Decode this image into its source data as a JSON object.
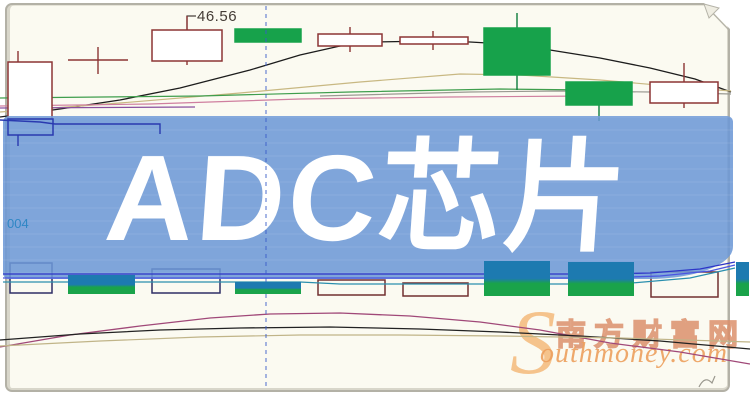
{
  "banner": {
    "title": "ADC芯片"
  },
  "price_flag": {
    "value": "46.56"
  },
  "left_label": {
    "value": "004"
  },
  "watermark": {
    "swoosh": "S",
    "cn": "南方财富网",
    "en": "outhmoney.com"
  },
  "colors": {
    "banner_fill": "rgba(108,152,214,0.87)",
    "banner_text": "#ffffff",
    "candle_up_stroke": "#8c3434",
    "candle_down_fill": "#17a24b",
    "down_wick": "#0e7d3c",
    "vol_teal": "#1d7ab0",
    "vol_green": "#1aa34a",
    "hollow_navy": "#2e2e66",
    "hollow_maroon": "#713030",
    "ma_black": "#1c1c1c",
    "ma_tan": "#c8b882",
    "ma_green": "#3f9e4d",
    "ma_pink": "#cf7f9f",
    "ma_purple": "#8a4f9e",
    "ma_gray": "#9a9a92",
    "ma_navy": "#2a3ab0",
    "ind_navy": "#2d35c8",
    "ind_blue": "#4a55e0",
    "ind_teal": "#2a8fae",
    "dash_blue": "#3a5cc8",
    "curve_magenta": "#a04878",
    "curve_black": "#222222",
    "curve_tan": "#c0b488",
    "flag": "#4a423c",
    "wm_orange": "#e8a060"
  },
  "chart_data": {
    "type": "candlestick",
    "title": "ADC芯片",
    "note": "stock K-line chart, no numeric axes visible; one flagged price 46.56; geometry in screenshot pixels",
    "candles": [
      {
        "type": "up",
        "x": 8,
        "y": 62,
        "w": 44,
        "h": 57,
        "wicks": [
          [
            18,
            51,
            62
          ]
        ]
      },
      {
        "type": "doji",
        "h": [
          68,
          128,
          60
        ],
        "v": [
          98,
          47,
          74
        ]
      },
      {
        "type": "up",
        "x": 152,
        "y": 30,
        "w": 70,
        "h": 31,
        "wicks": [
          [
            187,
            16,
            30
          ],
          [
            187,
            61,
            65
          ]
        ]
      },
      {
        "type": "down",
        "x": 235,
        "y": 29,
        "w": 66,
        "h": 13
      },
      {
        "type": "up",
        "x": 318,
        "y": 34,
        "w": 64,
        "h": 12,
        "wicks": [
          [
            350,
            27,
            34
          ],
          [
            350,
            46,
            52
          ]
        ]
      },
      {
        "type": "up",
        "x": 400,
        "y": 37,
        "w": 68,
        "h": 7,
        "wicks": [
          [
            433,
            31,
            37
          ],
          [
            433,
            44,
            50
          ]
        ]
      },
      {
        "type": "down",
        "x": 484,
        "y": 28,
        "w": 66,
        "h": 47,
        "wicks": [
          [
            517,
            13,
            28
          ],
          [
            517,
            75,
            90
          ]
        ]
      },
      {
        "type": "down",
        "x": 566,
        "y": 82,
        "w": 66,
        "h": 23,
        "wicks": [
          [
            599,
            105,
            121
          ]
        ]
      },
      {
        "type": "up",
        "x": 650,
        "y": 82,
        "w": 68,
        "h": 21,
        "wicks": [
          [
            684,
            63,
            82
          ],
          [
            684,
            103,
            108
          ]
        ]
      },
      {
        "type": "navy",
        "x": 8,
        "y": 119,
        "w": 45,
        "h": 16,
        "wicks": [
          [
            18,
            135,
            146
          ]
        ],
        "layer": "over"
      }
    ],
    "volume_bars": [
      {
        "kind": "hollow",
        "x": 10,
        "y": 263,
        "w": 42,
        "h": 30,
        "stroke": "hollow_navy"
      },
      {
        "kind": "filled",
        "x": 68,
        "y": 275,
        "w": 67,
        "h": 19
      },
      {
        "kind": "hollow",
        "x": 152,
        "y": 269,
        "w": 68,
        "h": 24,
        "stroke": "hollow_navy"
      },
      {
        "kind": "filled",
        "x": 235,
        "y": 282,
        "w": 66,
        "h": 12
      },
      {
        "kind": "hollow",
        "x": 318,
        "y": 280,
        "w": 67,
        "h": 15,
        "stroke": "hollow_maroon"
      },
      {
        "kind": "hollow",
        "x": 403,
        "y": 283,
        "w": 65,
        "h": 13,
        "stroke": "hollow_maroon"
      },
      {
        "kind": "filled",
        "x": 484,
        "y": 261,
        "w": 66,
        "h": 35
      },
      {
        "kind": "filled",
        "x": 568,
        "y": 262,
        "w": 66,
        "h": 34
      },
      {
        "kind": "hollow",
        "x": 651,
        "y": 272,
        "w": 67,
        "h": 25,
        "stroke": "hollow_maroon"
      },
      {
        "kind": "filled",
        "x": 736,
        "y": 262,
        "w": 13,
        "h": 34
      }
    ],
    "lines": [
      {
        "name": "ma-black-top",
        "color": "ma_black",
        "width": 1.3,
        "points": [
          [
            0,
            117
          ],
          [
            60,
            109
          ],
          [
            120,
            100
          ],
          [
            180,
            88
          ],
          [
            250,
            70
          ],
          [
            300,
            55
          ],
          [
            340,
            46
          ],
          [
            375,
            42
          ],
          [
            430,
            41
          ],
          [
            470,
            42
          ],
          [
            505,
            44
          ],
          [
            550,
            50
          ],
          [
            600,
            58
          ],
          [
            650,
            68
          ],
          [
            695,
            79
          ],
          [
            731,
            92
          ]
        ]
      },
      {
        "name": "ma-tan-top",
        "color": "ma_tan",
        "width": 1.2,
        "points": [
          [
            0,
            112
          ],
          [
            120,
            103
          ],
          [
            240,
            93
          ],
          [
            360,
            82
          ],
          [
            460,
            74
          ],
          [
            520,
            75
          ],
          [
            600,
            80
          ],
          [
            680,
            87
          ],
          [
            731,
            91
          ]
        ]
      },
      {
        "name": "ma-green-top",
        "color": "ma_green",
        "width": 1.2,
        "points": [
          [
            0,
            98
          ],
          [
            200,
            96
          ],
          [
            350,
            92
          ],
          [
            500,
            89
          ],
          [
            590,
            90
          ]
        ]
      },
      {
        "name": "ma-gray-top",
        "color": "ma_gray",
        "width": 1.2,
        "points": [
          [
            320,
            96
          ],
          [
            470,
            92
          ],
          [
            560,
            91
          ],
          [
            650,
            92
          ],
          [
            731,
            94
          ]
        ]
      },
      {
        "name": "ma-pink-top",
        "color": "ma_pink",
        "width": 1.2,
        "points": [
          [
            0,
            106
          ],
          [
            150,
            104
          ],
          [
            300,
            99
          ],
          [
            450,
            97
          ],
          [
            590,
            96
          ]
        ]
      },
      {
        "name": "ma-purple-top",
        "color": "ma_purple",
        "width": 1.3,
        "points": [
          [
            0,
            108
          ],
          [
            195,
            107
          ]
        ]
      },
      {
        "name": "ma-navy-left",
        "color": "ma_navy",
        "width": 1.4,
        "layer": "over",
        "points": [
          [
            0,
            120
          ],
          [
            40,
            122
          ],
          [
            55,
            124
          ],
          [
            160,
            124
          ],
          [
            160,
            134
          ]
        ]
      },
      {
        "name": "price-flag-pointer",
        "color": "flag",
        "width": 1.2,
        "points": [
          [
            187,
            30
          ],
          [
            187,
            16
          ],
          [
            196,
            16
          ]
        ]
      },
      {
        "name": "indicator-navy-1",
        "color": "ind_navy",
        "width": 1.3,
        "layer": "over",
        "points": [
          [
            3,
            274
          ],
          [
            600,
            274
          ],
          [
            650,
            273
          ],
          [
            700,
            269
          ],
          [
            735,
            262
          ]
        ]
      },
      {
        "name": "indicator-navy-2",
        "color": "ind_blue",
        "width": 1.3,
        "layer": "over",
        "points": [
          [
            3,
            278
          ],
          [
            600,
            278
          ],
          [
            660,
            276
          ],
          [
            710,
            271
          ],
          [
            735,
            265
          ]
        ]
      },
      {
        "name": "indicator-teal",
        "color": "ind_teal",
        "width": 1.2,
        "layer": "over",
        "points": [
          [
            3,
            282
          ],
          [
            300,
            282
          ],
          [
            340,
            284
          ],
          [
            620,
            284
          ],
          [
            690,
            278
          ],
          [
            735,
            268
          ]
        ]
      },
      {
        "name": "dashed-crosshair-vline",
        "color": "dash_blue",
        "width": 1.2,
        "layer": "over",
        "dash": "4 4",
        "opacity": 0.75,
        "points": [
          [
            266,
            6
          ],
          [
            266,
            390
          ]
        ]
      },
      {
        "name": "curve-magenta-bottom",
        "color": "curve_magenta",
        "width": 1.3,
        "points": [
          [
            0,
            347
          ],
          [
            70,
            335
          ],
          [
            140,
            326
          ],
          [
            210,
            318
          ],
          [
            270,
            314
          ],
          [
            340,
            313
          ],
          [
            410,
            316
          ],
          [
            480,
            322
          ],
          [
            540,
            330
          ],
          [
            610,
            343
          ],
          [
            680,
            352
          ],
          [
            750,
            364
          ]
        ]
      },
      {
        "name": "curve-black-bottom",
        "color": "curve_black",
        "width": 1.3,
        "points": [
          [
            0,
            340
          ],
          [
            80,
            334
          ],
          [
            160,
            330
          ],
          [
            240,
            328
          ],
          [
            330,
            327
          ],
          [
            420,
            329
          ],
          [
            500,
            332
          ],
          [
            580,
            336
          ],
          [
            660,
            341
          ],
          [
            750,
            349
          ]
        ]
      },
      {
        "name": "curve-tan-bottom",
        "color": "curve_tan",
        "width": 1.2,
        "points": [
          [
            0,
            346
          ],
          [
            100,
            341
          ],
          [
            200,
            337
          ],
          [
            300,
            335
          ],
          [
            400,
            335
          ],
          [
            500,
            336
          ],
          [
            620,
            338
          ],
          [
            750,
            342
          ]
        ]
      }
    ]
  }
}
